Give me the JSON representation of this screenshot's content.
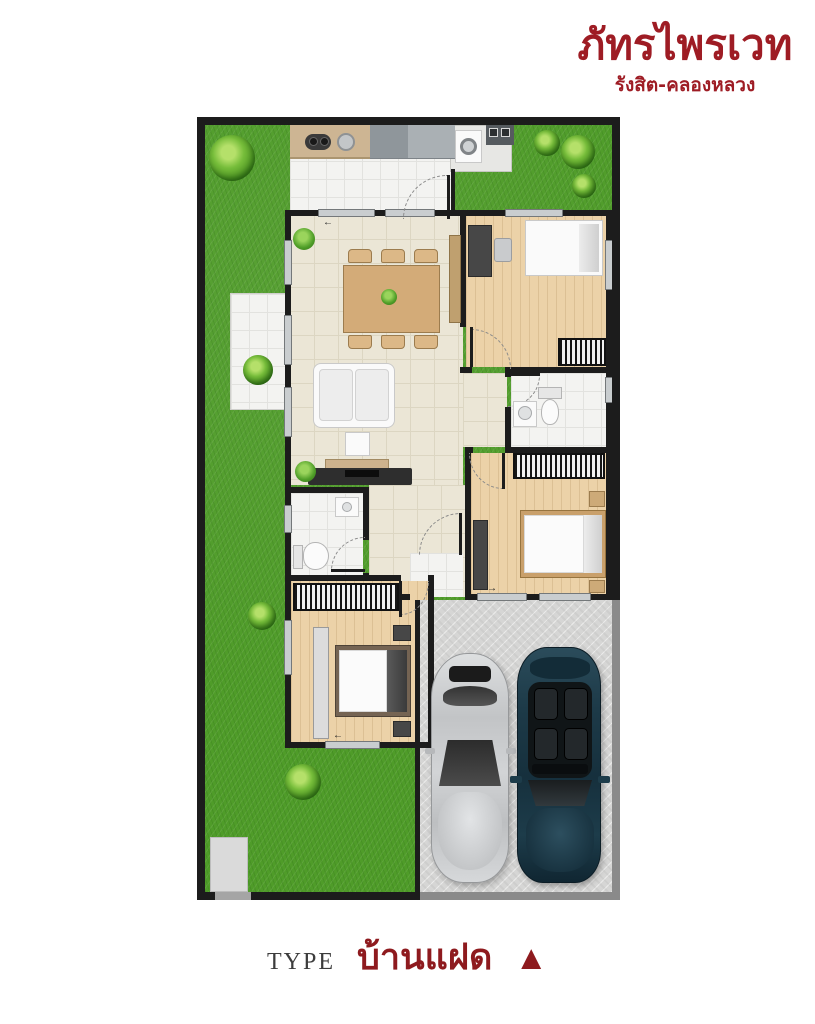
{
  "brand": {
    "title": "ภัทรไพรเวท",
    "subtitle": "รังสิต-คลองหลวง"
  },
  "caption": {
    "type_label": "TYPE",
    "type_value": "บ้านแฝด",
    "marker": "▲"
  },
  "colors": {
    "brand_red": "#9e1c24",
    "caption_red": "#8e1a1e",
    "grass": "#4f9c29",
    "wall": "#1c1c1c",
    "wood_floor": "#ecd2a8",
    "cream_floor": "#ebe6d6",
    "garage_gray": "#d6d6d5",
    "car_silver": "#c2c4c6",
    "car_dark": "#1d3c4a"
  },
  "plan_inventory": {
    "areas": [
      "backyard-lawn",
      "kitchen",
      "laundry-pad",
      "terrace",
      "living-dining-room",
      "hallway",
      "rear-porch",
      "bathroom-1",
      "bathroom-2",
      "bedroom-1",
      "bedroom-2",
      "bedroom-3",
      "garage",
      "concrete-pad"
    ],
    "objects": [
      "kitchen-counter",
      "cooktop",
      "kitchen-sink",
      "washing-machine",
      "laundry-sink",
      "dining-table",
      "six-chairs",
      "sofa",
      "coffee-table",
      "tv-cabinet",
      "sideboard",
      "beds",
      "wardrobes",
      "desks",
      "nightstands",
      "toilets",
      "wash-basins",
      "silver-car",
      "dark-car",
      "garden-bushes"
    ]
  }
}
